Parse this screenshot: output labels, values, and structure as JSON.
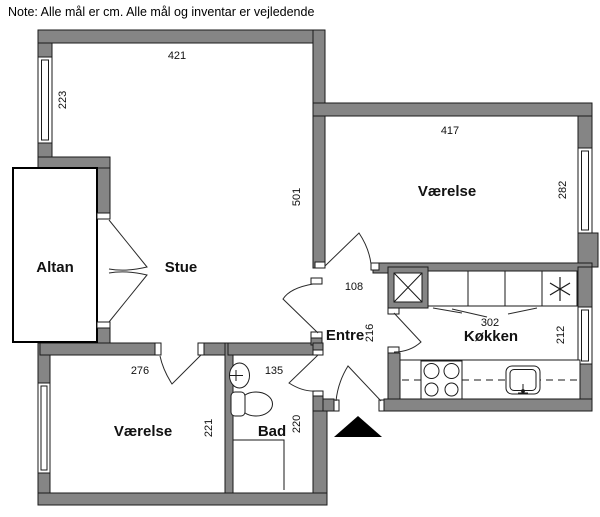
{
  "note": "Note: Alle mål er cm. Alle mål og inventar er vejledende",
  "rooms": {
    "stue": "Stue",
    "altan": "Altan",
    "entre": "Entre",
    "koekken": "Køkken",
    "bad": "Bad",
    "vaerelse_top": "Værelse",
    "vaerelse_bottom": "Værelse"
  },
  "dims": {
    "d421": "421",
    "d223": "223",
    "d501": "501",
    "d417": "417",
    "d282": "282",
    "d108": "108",
    "d216": "216",
    "d302": "302",
    "d212": "212",
    "d276": "276",
    "d221": "221",
    "d135": "135",
    "d220": "220"
  },
  "icons": {
    "entrance_arrow": "entrance-arrow",
    "shaft_box": "ventilation-shaft",
    "cooktop_star": "cooktop-star",
    "stove": "stove-4-burners",
    "kitchen_sink": "kitchen-sink",
    "bath_sink": "wash-basin",
    "toilet": "toilet",
    "windows": "window"
  },
  "colors": {
    "wall": "#858585",
    "outline": "#1a1a1a",
    "background": "#ffffff",
    "entrance_marker": "#000000"
  }
}
